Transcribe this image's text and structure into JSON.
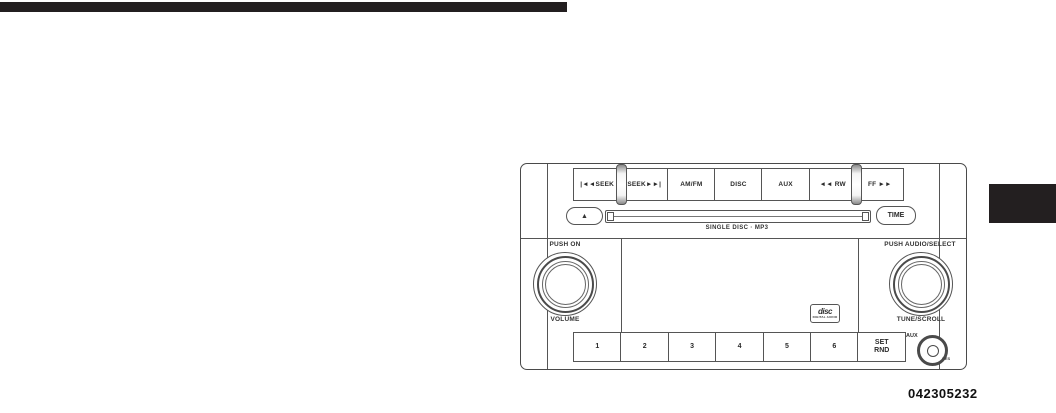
{
  "page": {
    "figure_code": "042305232"
  },
  "colors": {
    "header_bar": "#231f20",
    "side_tab": "#231f20",
    "diagram_line": "#4a4a4a"
  },
  "radio": {
    "top_buttons": [
      {
        "label": "|◄◄SEEK"
      },
      {
        "label": "SEEK►►|"
      },
      {
        "label": "AM/FM"
      },
      {
        "label": "DISC"
      },
      {
        "label": "AUX"
      },
      {
        "label": "◄◄ RW"
      },
      {
        "label": "FF ►►"
      }
    ],
    "eject_symbol": "▲",
    "time_button_label": "TIME",
    "slot_caption": "SINGLE DISC · MP3",
    "left_knob": {
      "top_label": "PUSH ON",
      "bottom_label": "VOLUME"
    },
    "right_knob": {
      "top_label": "PUSH AUDIO/SELECT",
      "bottom_label": "TUNE/SCROLL"
    },
    "preset_buttons": [
      {
        "label": "1"
      },
      {
        "label": "2"
      },
      {
        "label": "3"
      },
      {
        "label": "4"
      },
      {
        "label": "5"
      },
      {
        "label": "6"
      }
    ],
    "set_rnd": {
      "line1": "SET",
      "line2": "RND"
    },
    "aux_jack_label": "AUX",
    "res_label": "RES",
    "cd_logo": {
      "main": "disc",
      "sub": "DIGITAL AUDIO"
    }
  }
}
